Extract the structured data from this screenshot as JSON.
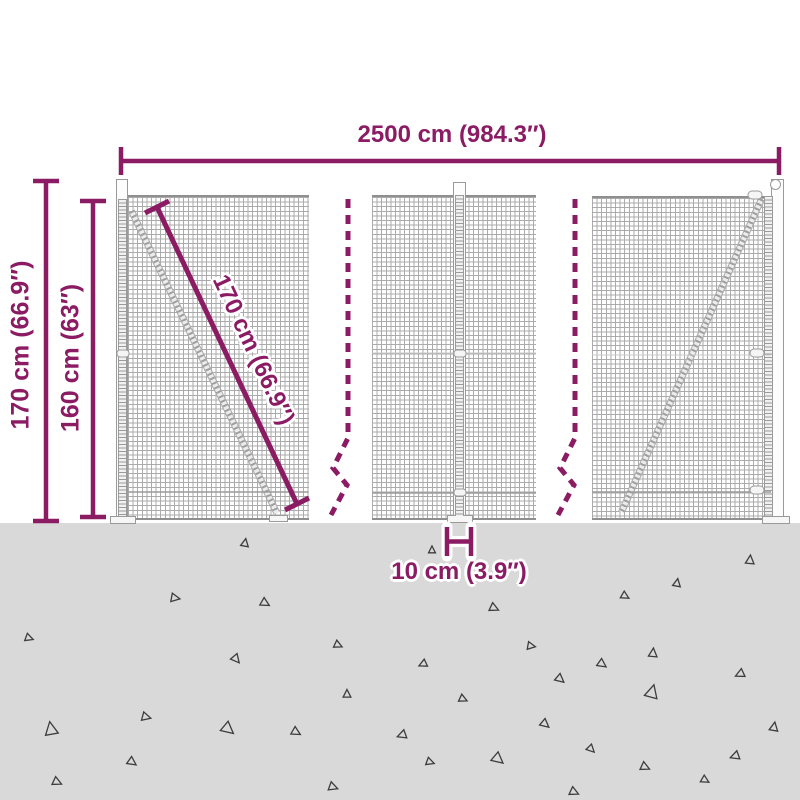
{
  "diagram": {
    "title": "wire mesh fence dimension diagram",
    "width_label": "2500 cm (984.3″)",
    "post_height_label": "170 cm (66.9″)",
    "mesh_height_label": "160 cm (63″)",
    "diagonal_label": "170 cm (66.9″)",
    "post_width_label": "10 cm (3.9″)"
  },
  "colors": {
    "dimension": "#8b1b63",
    "ground": "#d9d9d9",
    "mesh_line": "#ababab",
    "triangle_outline": "#3c3c3c"
  },
  "ground_triangles": [
    {
      "x": 245,
      "y": 543,
      "s": 0.9,
      "r": 10
    },
    {
      "x": 432,
      "y": 550,
      "s": 0.8,
      "r": 0
    },
    {
      "x": 750,
      "y": 560,
      "s": 1.0,
      "r": 5
    },
    {
      "x": 677,
      "y": 583,
      "s": 0.9,
      "r": 10
    },
    {
      "x": 175,
      "y": 598,
      "s": 1.0,
      "r": 100
    },
    {
      "x": 265,
      "y": 603,
      "s": 1.0,
      "r": 120
    },
    {
      "x": 625,
      "y": 596,
      "s": 0.9,
      "r": 120
    },
    {
      "x": 494,
      "y": 608,
      "s": 1.0,
      "r": 115
    },
    {
      "x": 29,
      "y": 638,
      "s": 0.9,
      "r": 110
    },
    {
      "x": 338,
      "y": 645,
      "s": 0.9,
      "r": 115
    },
    {
      "x": 531,
      "y": 646,
      "s": 0.9,
      "r": 100
    },
    {
      "x": 236,
      "y": 659,
      "s": 1.0,
      "r": 140
    },
    {
      "x": 653,
      "y": 653,
      "s": 1.0,
      "r": 5
    },
    {
      "x": 423,
      "y": 664,
      "s": 0.9,
      "r": 245
    },
    {
      "x": 602,
      "y": 664,
      "s": 1.0,
      "r": 125
    },
    {
      "x": 740,
      "y": 674,
      "s": 1.0,
      "r": 245
    },
    {
      "x": 560,
      "y": 679,
      "s": 1.0,
      "r": 130
    },
    {
      "x": 347,
      "y": 694,
      "s": 0.9,
      "r": 0
    },
    {
      "x": 463,
      "y": 699,
      "s": 0.9,
      "r": 115
    },
    {
      "x": 652,
      "y": 692,
      "s": 1.5,
      "r": 15
    },
    {
      "x": 146,
      "y": 717,
      "s": 1.0,
      "r": 105
    },
    {
      "x": 51,
      "y": 729,
      "s": 1.5,
      "r": -10
    },
    {
      "x": 228,
      "y": 729,
      "s": 1.4,
      "r": 130
    },
    {
      "x": 296,
      "y": 732,
      "s": 1.0,
      "r": 120
    },
    {
      "x": 545,
      "y": 724,
      "s": 1.0,
      "r": 130
    },
    {
      "x": 774,
      "y": 727,
      "s": 1.0,
      "r": 10
    },
    {
      "x": 402,
      "y": 735,
      "s": 1.0,
      "r": 250
    },
    {
      "x": 591,
      "y": 749,
      "s": 0.9,
      "r": 135
    },
    {
      "x": 735,
      "y": 756,
      "s": 1.0,
      "r": 250
    },
    {
      "x": 132,
      "y": 762,
      "s": 1.0,
      "r": 125
    },
    {
      "x": 430,
      "y": 762,
      "s": 0.9,
      "r": 110
    },
    {
      "x": 498,
      "y": 759,
      "s": 1.3,
      "r": 130
    },
    {
      "x": 645,
      "y": 767,
      "s": 1.0,
      "r": 115
    },
    {
      "x": 57,
      "y": 782,
      "s": 1.0,
      "r": 115
    },
    {
      "x": 705,
      "y": 780,
      "s": 0.9,
      "r": 120
    },
    {
      "x": 333,
      "y": 787,
      "s": 1.0,
      "r": 110
    },
    {
      "x": 574,
      "y": 792,
      "s": 1.0,
      "r": 115
    }
  ]
}
